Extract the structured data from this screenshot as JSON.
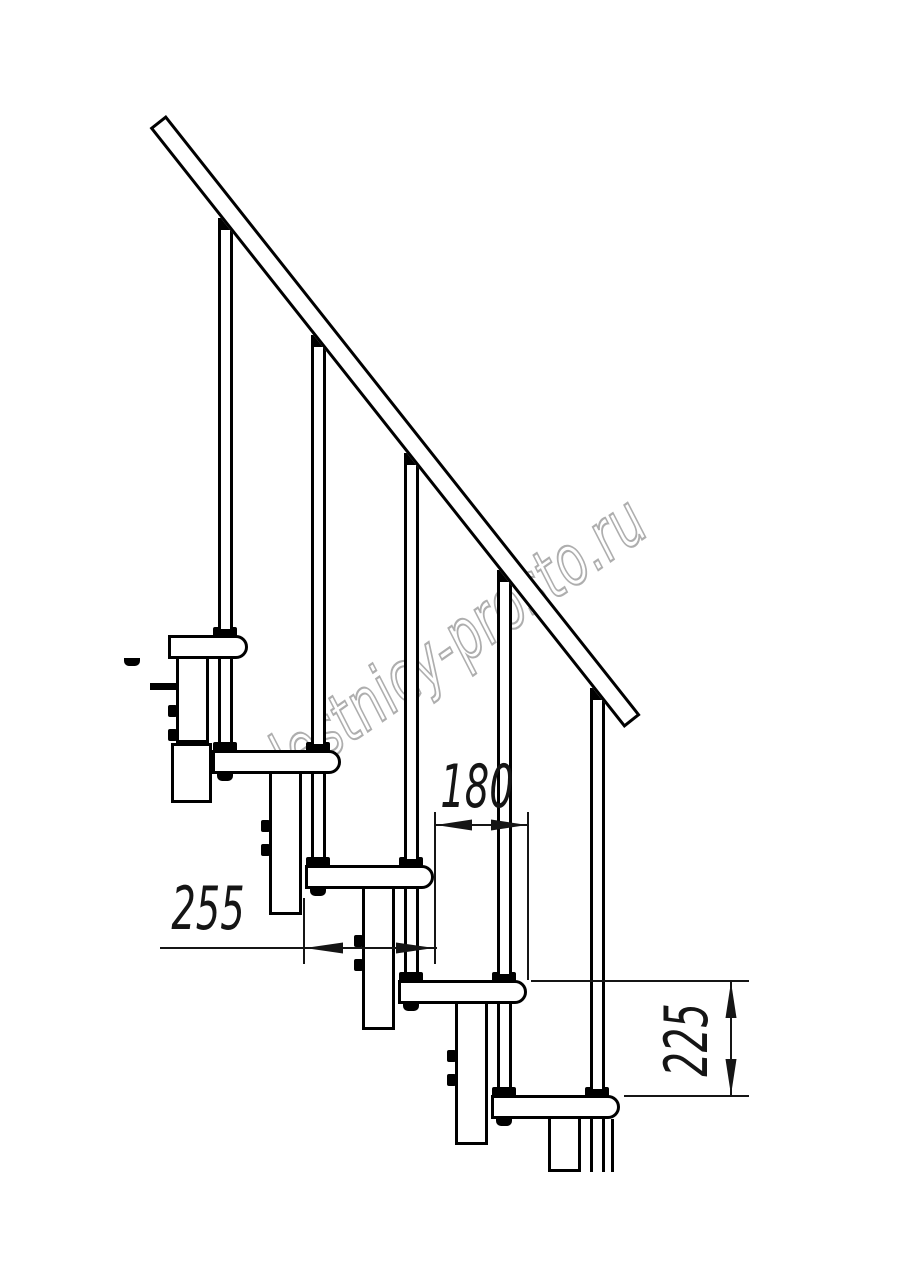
{
  "drawing": {
    "watermark": "lestnicy-prosto.ru",
    "dimensions": {
      "tread_depth_label": "255",
      "run_label": "180",
      "rise_label": "225"
    },
    "colors": {
      "line": "#000000",
      "dimension_line": "#151515",
      "watermark_stroke": "#aeaeae",
      "background": "#ffffff"
    },
    "geometry": {
      "tread_width_px": 129,
      "tread_height_px": 24,
      "run_px": 93,
      "rise_px": 115,
      "rail": {
        "x": 166,
        "y": 115,
        "length": 765,
        "thickness": 21,
        "angle_deg": 51.65,
        "slope": 1.264
      },
      "rod": {
        "offset_from_left": 106,
        "width": 15
      },
      "column": {
        "offset_from_left": 57,
        "width": 33,
        "drop_below_next_top": 50
      },
      "cut_bottom_y": 1172,
      "steps": [
        {
          "left": 119,
          "top": 635,
          "clip_left": 168
        },
        {
          "left": 212,
          "top": 750
        },
        {
          "left": 305,
          "top": 865
        },
        {
          "left": 398,
          "top": 980
        },
        {
          "left": 491,
          "top": 1095
        }
      ]
    }
  }
}
